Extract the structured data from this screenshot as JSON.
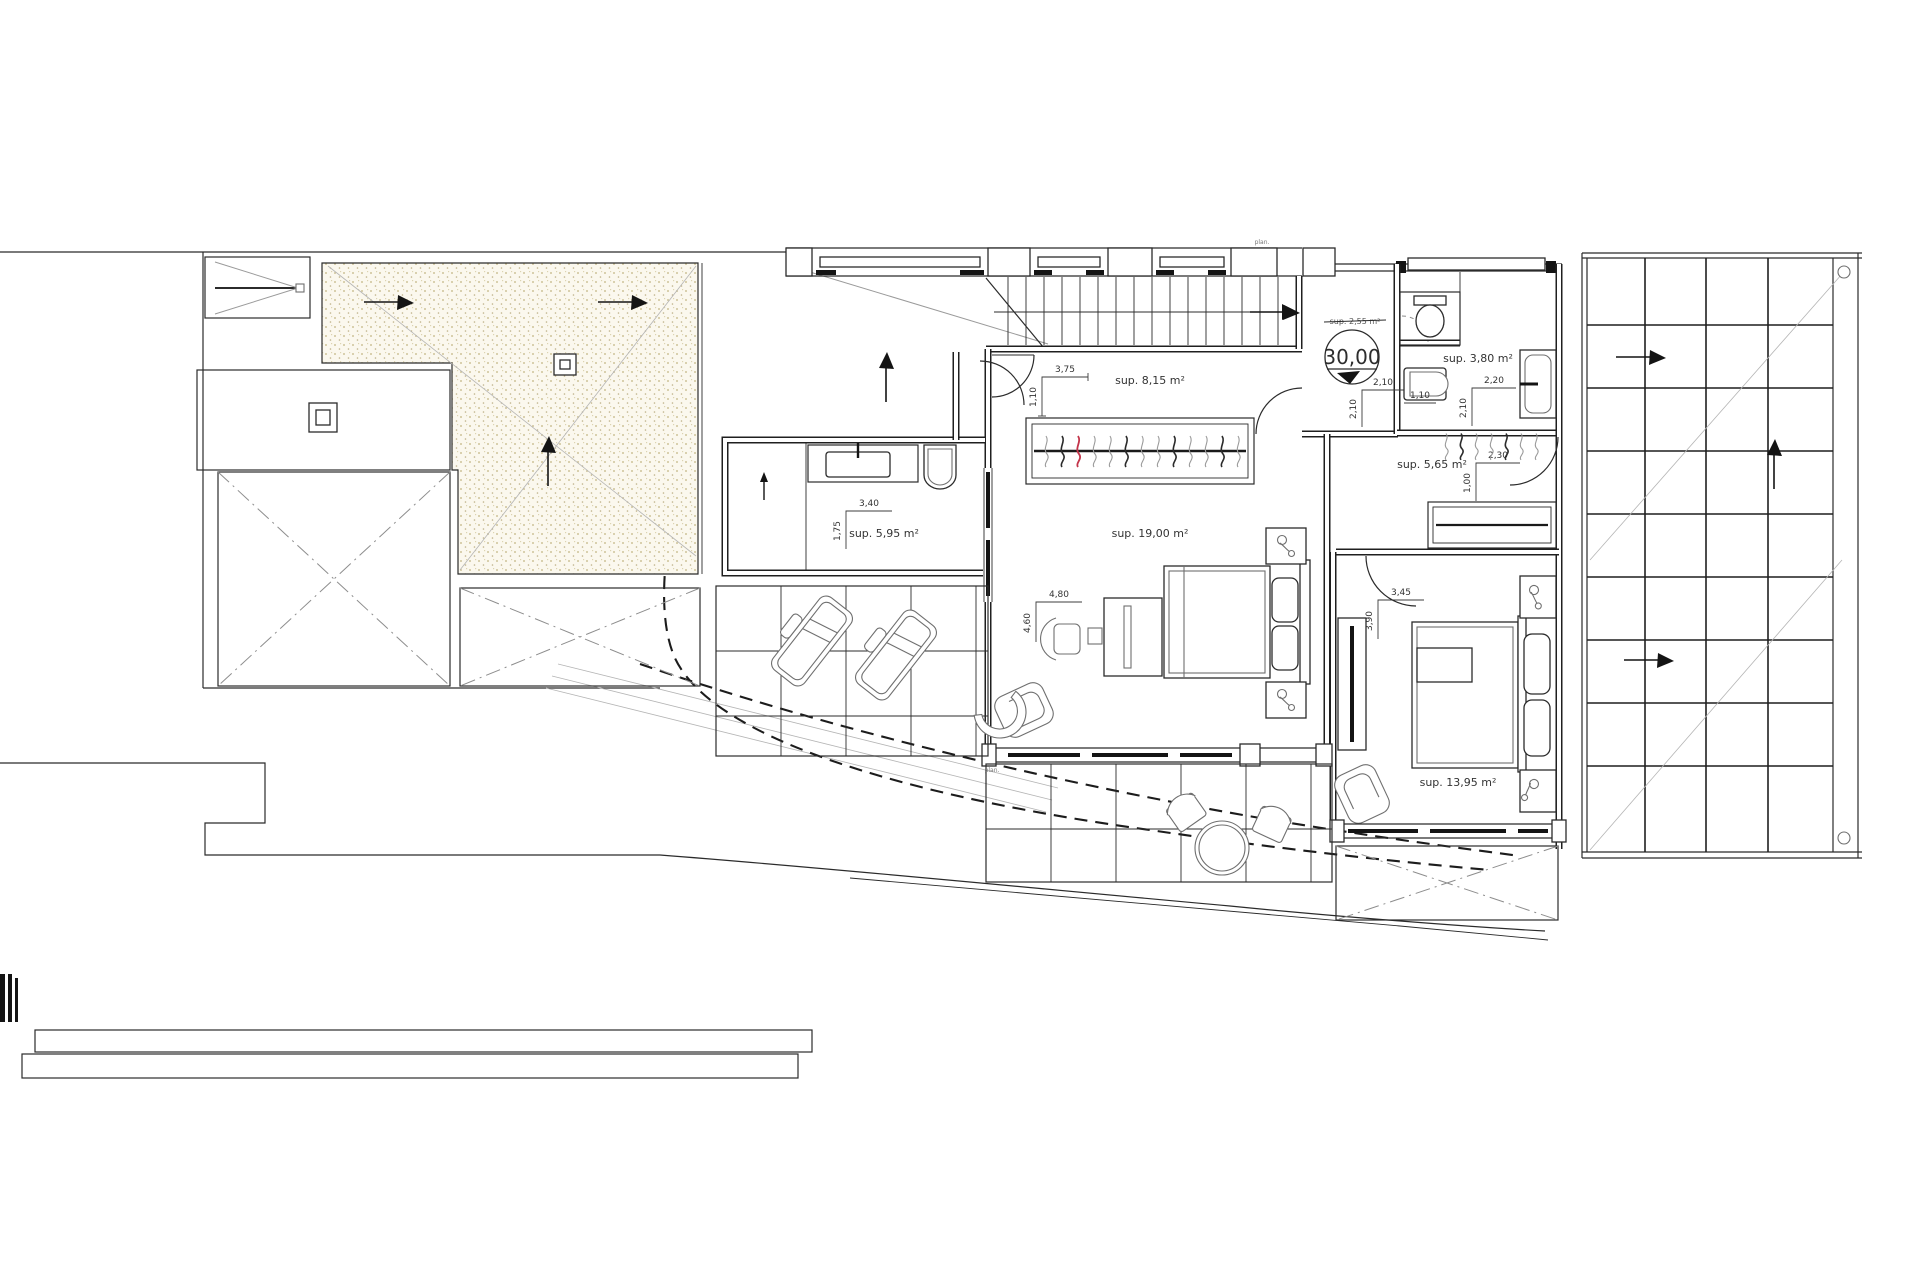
{
  "title": "floor-plan-upper-level",
  "colors": {
    "ink": "#2b2b2b",
    "gray": "#9a9a9a",
    "sand": "#cfc399",
    "red_item": "#c3344a",
    "bg": "#ffffff"
  },
  "labels": {
    "room_corridor": "sup. 8,15 m²",
    "room_bedroom1": "sup. 19,00 m²",
    "room_bath1": "sup. 5,95 m²",
    "room_bath2": "sup. 3,80 m²",
    "room_hall2": "sup. 5,65 m²",
    "room_bedroom2": "sup. 13,95 m²",
    "room_landing_struck": "sup. 2,55 m²",
    "level_value": "30,00",
    "dim_corridor_w": "3,75",
    "dim_corridor_h": "1,10",
    "dim_bedroom1_w": "4,80",
    "dim_bedroom1_h": "4,60",
    "dim_bath1_w": "3,40",
    "dim_bath1_h": "1,75",
    "dim_bath2_w": "2,20",
    "dim_bath2_h": "2,10",
    "dim_landing_w": "2,10",
    "dim_landing_h": "2,10",
    "dim_hall2_w": "2,30",
    "dim_hall2_h": "1,00",
    "dim_hall2_entry": "1,10",
    "dim_bedroom2_w": "3,45",
    "dim_bedroom2_h": "3,90",
    "micro_top": "plan.",
    "micro_terrace": "plan."
  }
}
